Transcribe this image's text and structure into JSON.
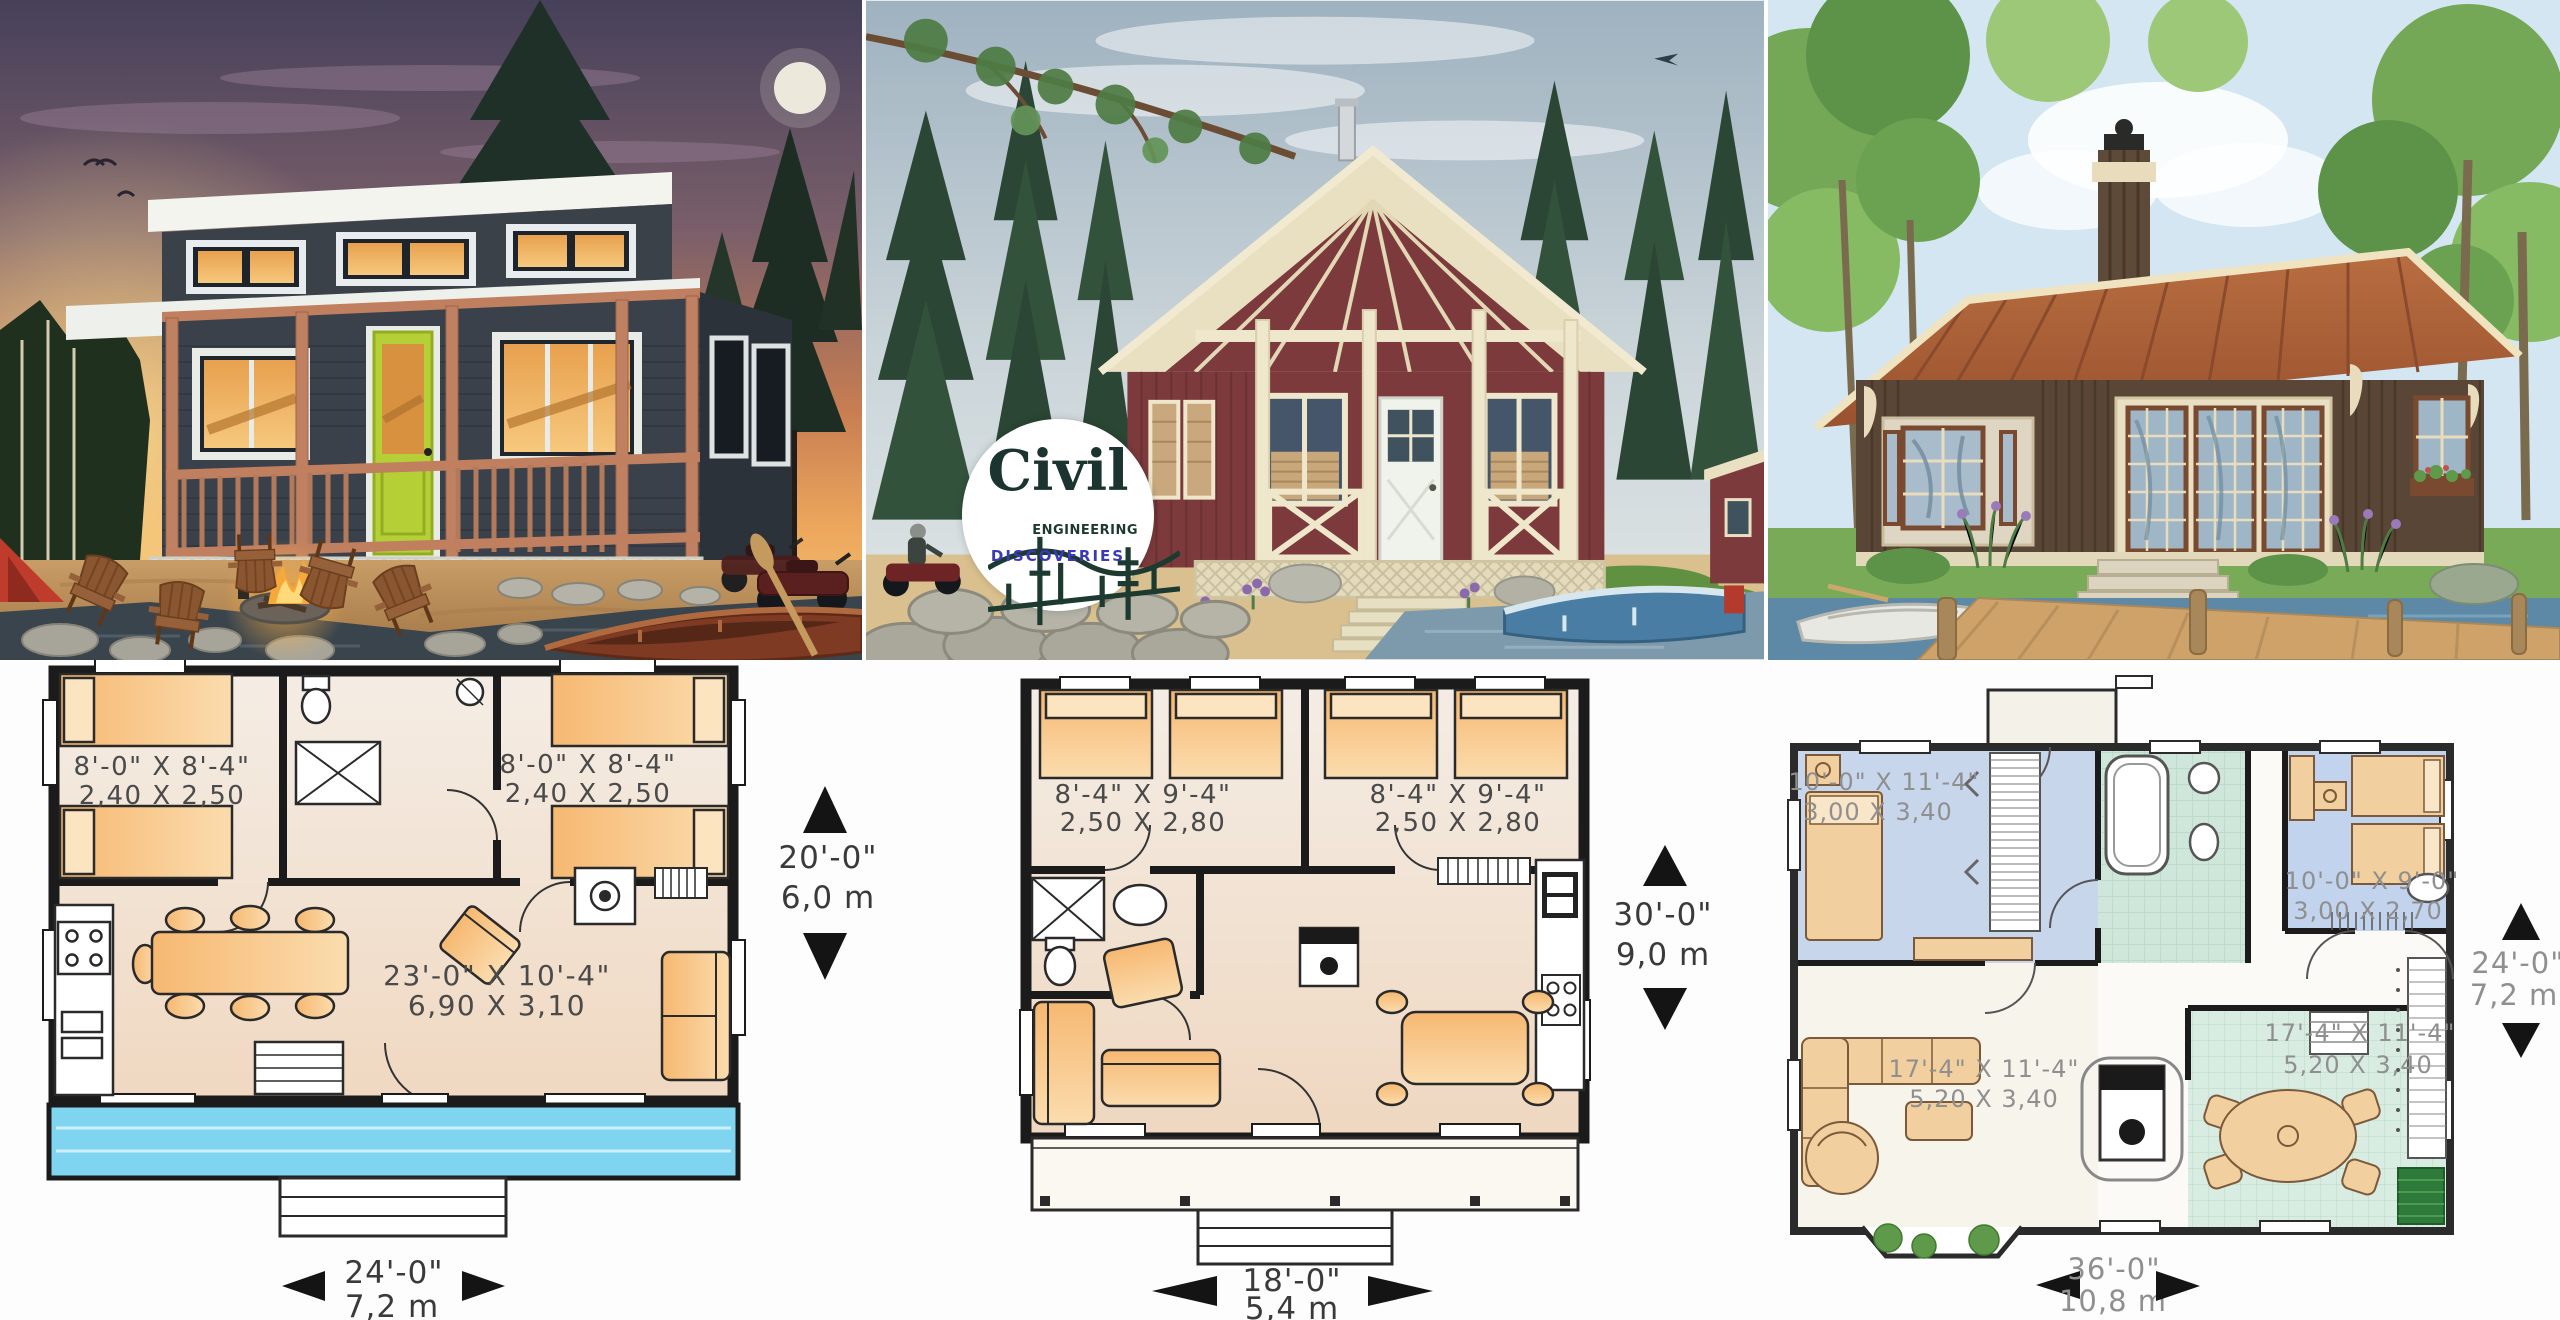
{
  "logo": {
    "brand": "Civil",
    "word_engineering": "ENGINEERING",
    "word_discoveries": "DISCOVERIES",
    "brand_color": "#1c3430",
    "discoveries_color": "#3a3ab8"
  },
  "colors": {
    "deck_blue": "#7fd4f0",
    "furniture_orange": "#f6b871",
    "door_green": "#b5cf36",
    "plan_label_gray": "#4a4a4a",
    "plan3_label_gray": "#8f8f8f"
  },
  "plans": {
    "a": {
      "bedroom_left": {
        "imperial": "8'-0\" X 8'-4\"",
        "metric": "2,40 X 2,50"
      },
      "bedroom_right": {
        "imperial": "8'-0\" X 8'-4\"",
        "metric": "2,40 X 2,50"
      },
      "living": {
        "imperial": "23'-0\" X 10'-4\"",
        "metric": "6,90 X 3,10"
      },
      "depth": {
        "imperial": "20'-0\"",
        "metric": "6,0 m"
      },
      "width": {
        "imperial": "24'-0\"",
        "metric": "7,2 m"
      }
    },
    "b": {
      "bedroom_left": {
        "imperial": "8'-4\" X 9'-4\"",
        "metric": "2,50 X 2,80"
      },
      "bedroom_right": {
        "imperial": "8'-4\" X 9'-4\"",
        "metric": "2,50 X 2,80"
      },
      "depth": {
        "imperial": "30'-0\"",
        "metric": "9,0 m"
      },
      "width": {
        "imperial": "18'-0\"",
        "metric": "5,4 m"
      }
    },
    "c": {
      "bedroom_left": {
        "imperial": "10'-0\" X 11'-4\"",
        "metric": "3,00 X 3,40"
      },
      "bedroom_right": {
        "imperial": "10'-0\" X 9'-0\"",
        "metric": "3,00 X 2,70"
      },
      "living": {
        "imperial": "17'-4\" X 11'-4\"",
        "metric": "5,20 X 3,40"
      },
      "dining": {
        "imperial": "17'-4\" X 11'-4\"",
        "metric": "5,20 X 3,40"
      },
      "depth": {
        "imperial": "24'-0\"",
        "metric": "7,2 m"
      },
      "width": {
        "imperial": "36'-0\"",
        "metric": "10,8 m"
      }
    }
  }
}
